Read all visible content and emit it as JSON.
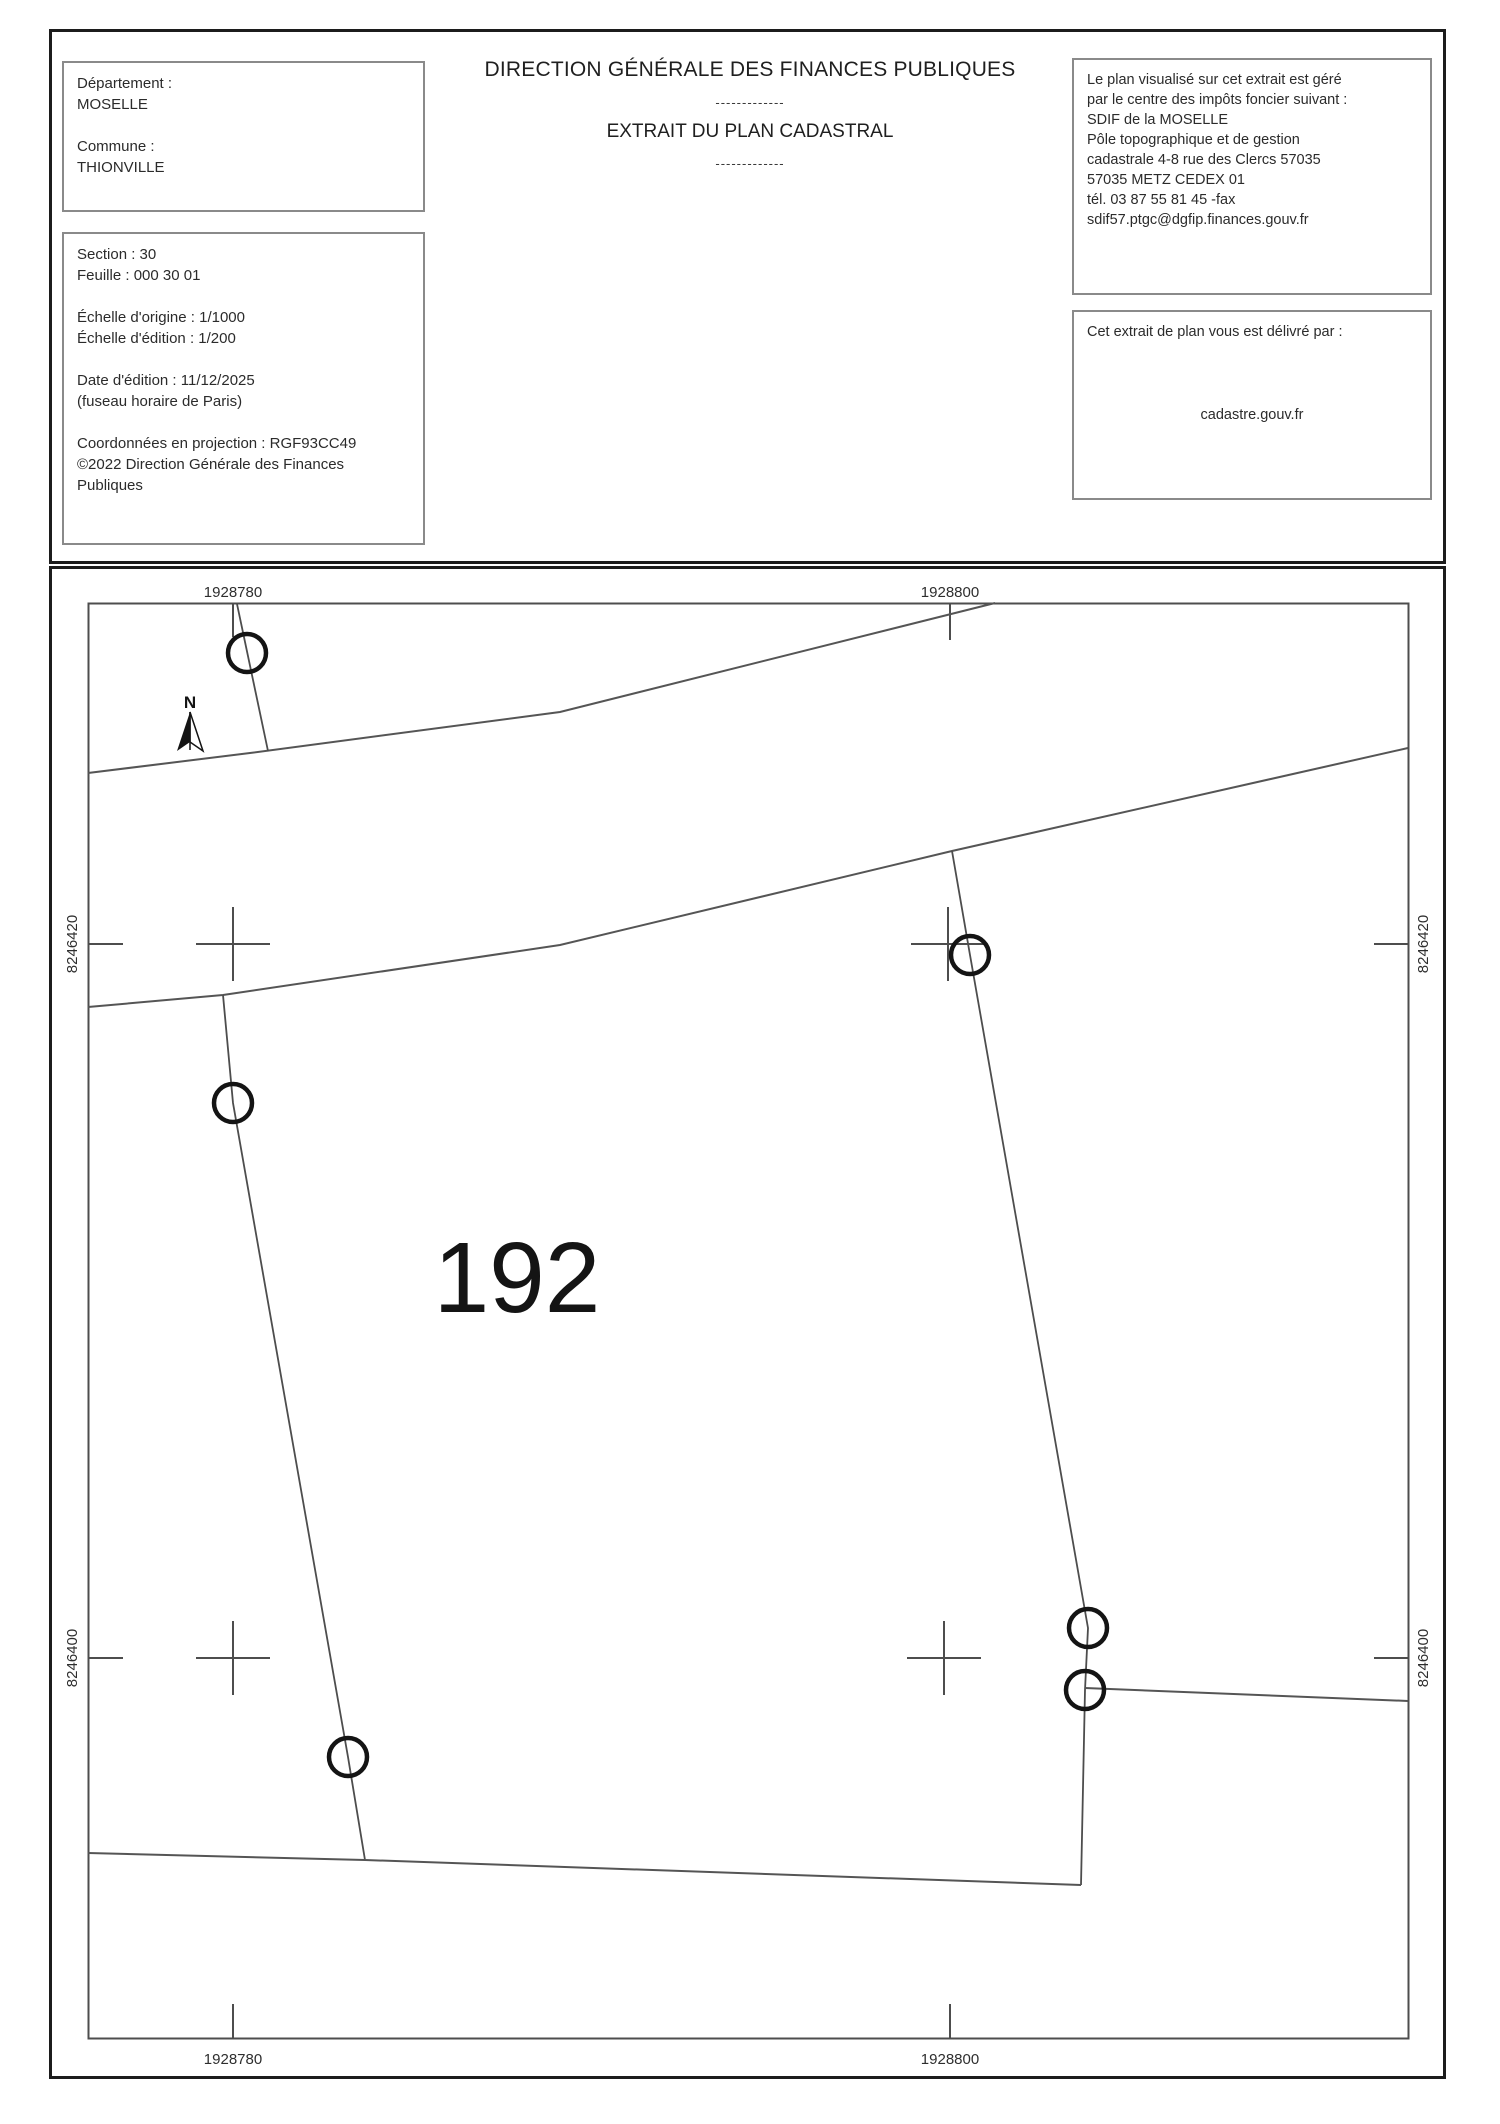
{
  "header": {
    "left_box1": {
      "lines": [
        "Département :",
        "MOSELLE",
        "",
        "Commune :",
        "THIONVILLE"
      ]
    },
    "left_box2": {
      "lines": [
        "Section : 30",
        "Feuille : 000 30 01",
        "",
        "Échelle d'origine : 1/1000",
        "Échelle d'édition : 1/200",
        "",
        "Date d'édition : 11/12/2025",
        "(fuseau horaire de Paris)",
        "",
        "Coordonnées en projection : RGF93CC49",
        "©2022 Direction Générale des Finances",
        "Publiques"
      ]
    },
    "title": {
      "line1": "DIRECTION GÉNÉRALE DES FINANCES PUBLIQUES",
      "separator": "-------------",
      "line2": "EXTRAIT DU PLAN CADASTRAL"
    },
    "right_box1": {
      "lines": [
        "Le plan visualisé sur cet extrait est géré",
        "par le centre des impôts foncier suivant :",
        "SDIF de la MOSELLE",
        "Pôle topographique et de gestion",
        "cadastrale 4-8 rue des Clercs 57035",
        "57035 METZ CEDEX 01",
        "tél. 03 87 55 81 45 -fax",
        "sdif57.ptgc@dgfip.finances.gouv.fr"
      ]
    },
    "right_box2": {
      "title": "Cet extrait de plan vous est délivré par :",
      "provider": "cadastre.gouv.fr"
    }
  },
  "map": {
    "parcel_number": "192",
    "north_label": "N",
    "x_ticks": [
      {
        "label": "1928780"
      },
      {
        "label": "1928800"
      }
    ],
    "y_ticks": [
      {
        "label": "8246420"
      },
      {
        "label": "8246400"
      }
    ],
    "colors": {
      "frame": "#4d4d4d",
      "road_line": "#555555",
      "survey_point": "#141414",
      "section_border": "#1c1c1c"
    }
  }
}
